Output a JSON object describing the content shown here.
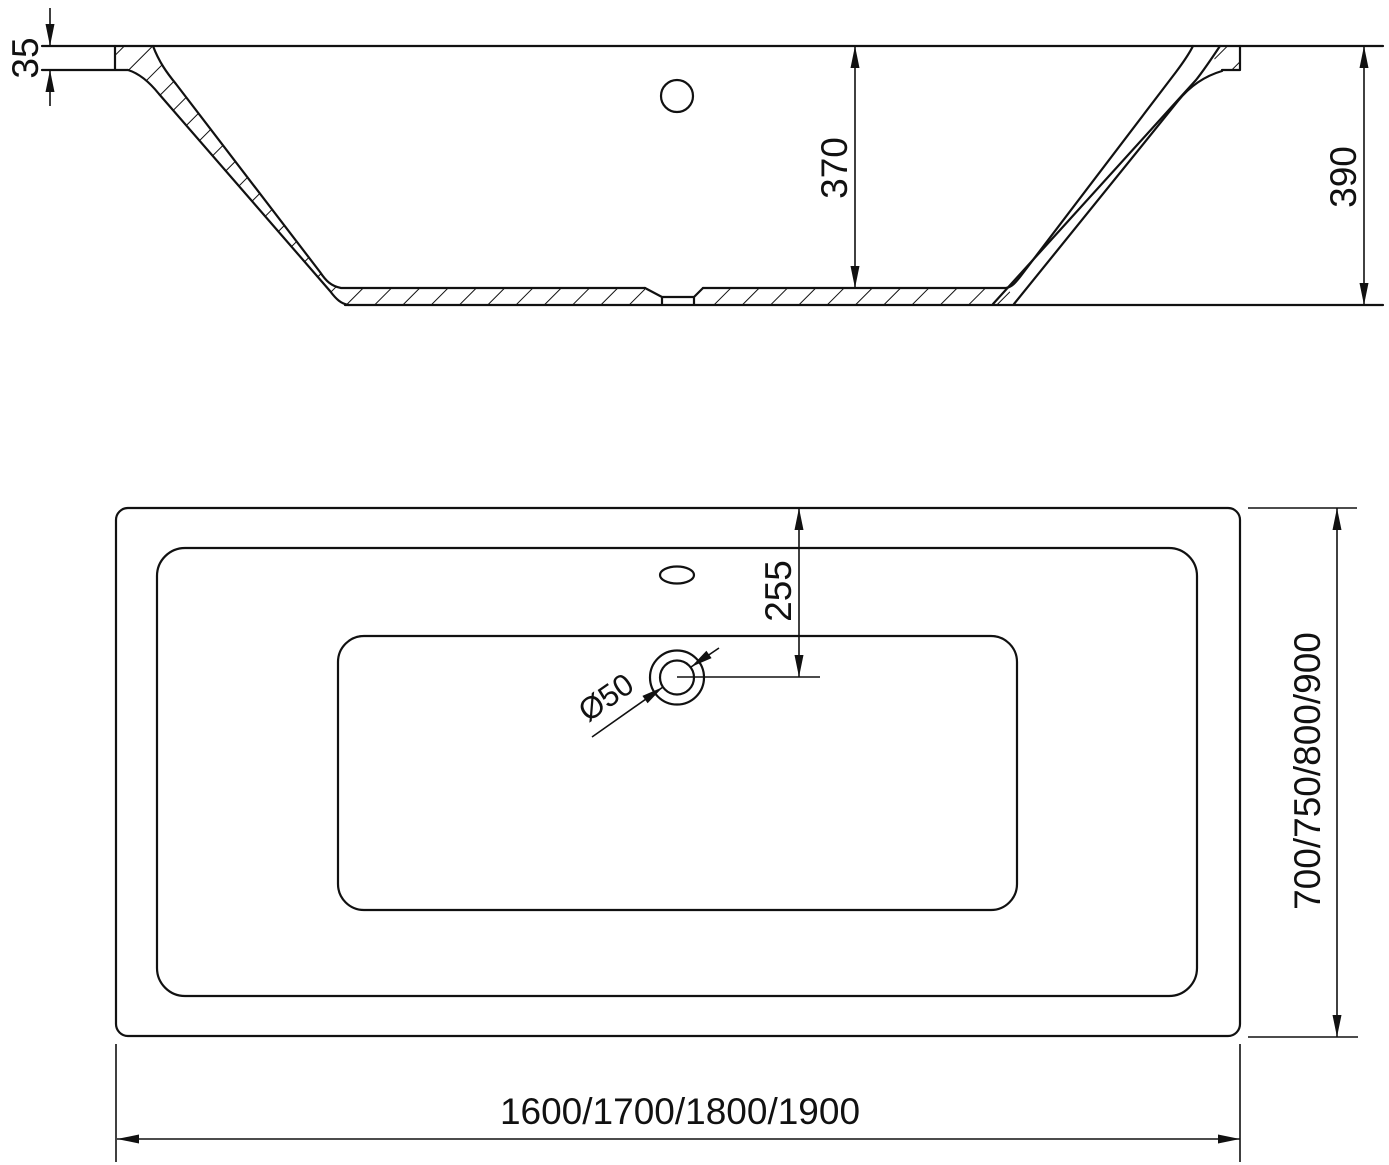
{
  "drawing": {
    "colors": {
      "line": "#111111",
      "background": "#ffffff"
    },
    "side_view": {
      "dim_rim_thickness": "35",
      "dim_inner_depth": "370",
      "dim_total_height": "390"
    },
    "plan_view": {
      "dim_drain_offset": "255",
      "dim_drain_diameter": "Ø50",
      "dim_widths": "700/750/800/900",
      "dim_lengths": "1600/1700/1800/1900"
    }
  }
}
